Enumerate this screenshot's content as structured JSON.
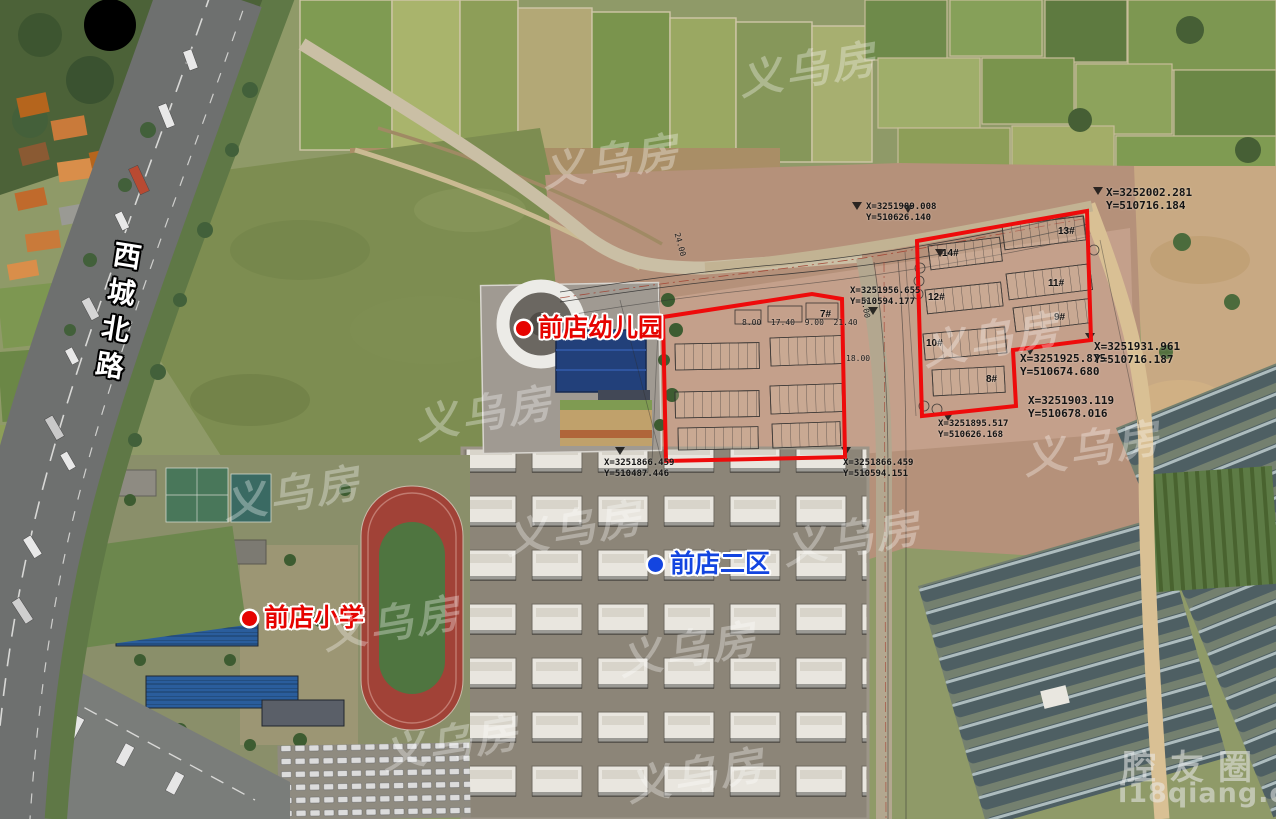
{
  "road_label": {
    "text": "西城北路"
  },
  "pois": [
    {
      "label": "前店幼儿园",
      "type": "kindergarten",
      "marker_color": "#e60300"
    },
    {
      "label": "前店二区",
      "type": "residential-district",
      "marker_color": "#1345e0"
    },
    {
      "label": "前店小学",
      "type": "primary-school",
      "marker_color": "#e60300"
    }
  ],
  "plots": {
    "outline_color": "#ee0b0b",
    "labels": [
      "7#",
      "14#",
      "13#",
      "12#",
      "11#",
      "10#",
      "9#",
      "8#"
    ]
  },
  "coordinate_markers": [
    {
      "x_label": "X=3251989.008",
      "y_label": "Y=510626.140"
    },
    {
      "x_label": "X=3252002.281",
      "y_label": "Y=510716.184"
    },
    {
      "x_label": "X=3251956.655",
      "y_label": "Y=510594.177"
    },
    {
      "x_label": "X=3251866.459",
      "y_label": "Y=510487.446"
    },
    {
      "x_label": "X=3251866.459",
      "y_label": "Y=510594.151"
    },
    {
      "x_label": "X=3251895.517",
      "y_label": "Y=510626.168"
    },
    {
      "x_label": "X=3251925.875",
      "y_label": "Y=510674.680"
    },
    {
      "x_label": "X=3251903.119",
      "y_label": "Y=510678.016"
    },
    {
      "x_label": "X=3251931.961",
      "y_label": "Y=510716.187"
    }
  ],
  "dimension_labels": [
    "24.00",
    "8.00  17.40  9.00  21.40",
    "6.00",
    "18.00"
  ],
  "watermark": {
    "site_name": "腔友圈",
    "site_url": "i18qiang.com",
    "logo_text": "义乌房"
  },
  "colors": {
    "poi_red": "#e60300",
    "poi_blue": "#1345e0",
    "plot_outline": "#ee0b0b"
  }
}
